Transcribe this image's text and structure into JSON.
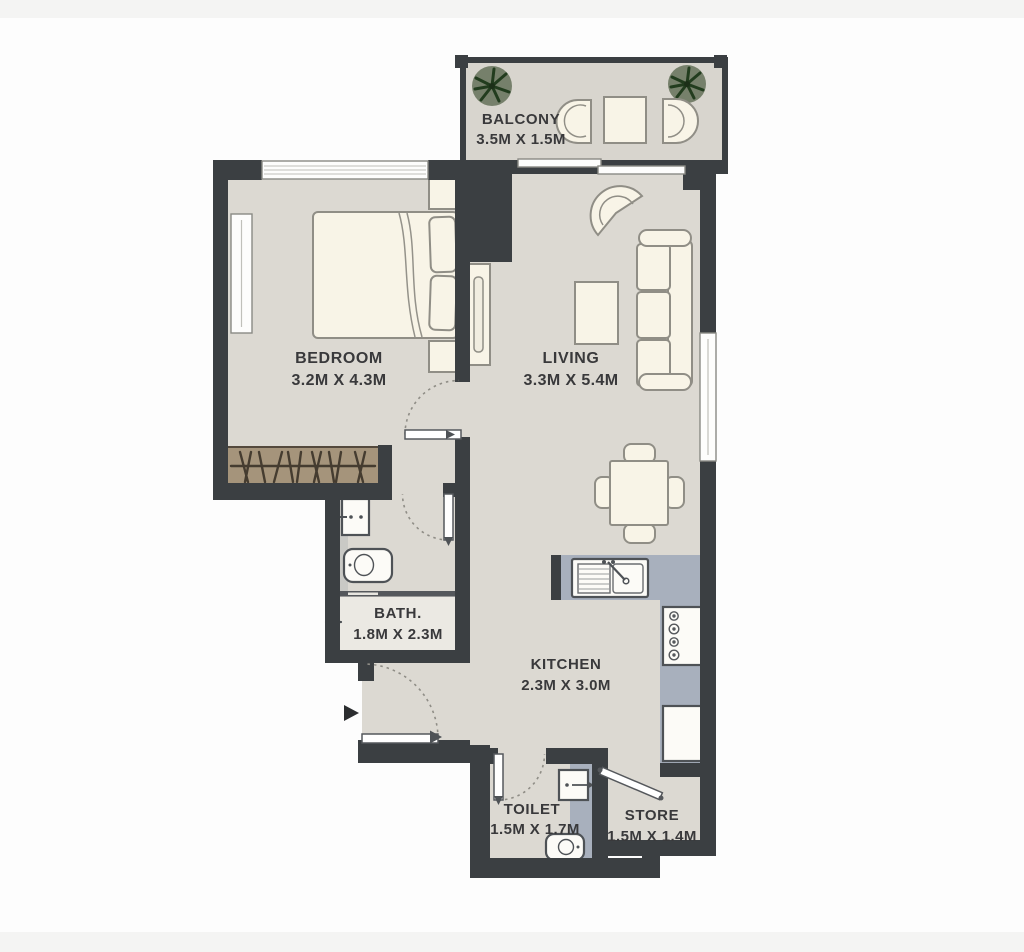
{
  "rooms": {
    "balcony": {
      "label": "BALCONY",
      "dims": "3.5M X 1.5M"
    },
    "bedroom": {
      "label": "BEDROOM",
      "dims": "3.2M X 4.3M"
    },
    "living": {
      "label": "LIVING",
      "dims": "3.3M X 5.4M"
    },
    "bath": {
      "label": "BATH.",
      "dims": "1.8M X 2.3M"
    },
    "kitchen": {
      "label": "KITCHEN",
      "dims": "2.3M X 3.0M"
    },
    "toilet": {
      "label": "TOILET",
      "dims": "1.5M X 1.7M"
    },
    "store": {
      "label": "STORE",
      "dims": "1.5M X 1.4M"
    }
  },
  "colors": {
    "wall": "#3b3f42",
    "floor": "#dcd9d2",
    "furniture": "#f8f4e7",
    "kitchen_counter": "#a8b0bd",
    "wardrobe": "#a5947b",
    "plant_foliage": "#2f4a28",
    "label_text": "#39393b"
  }
}
